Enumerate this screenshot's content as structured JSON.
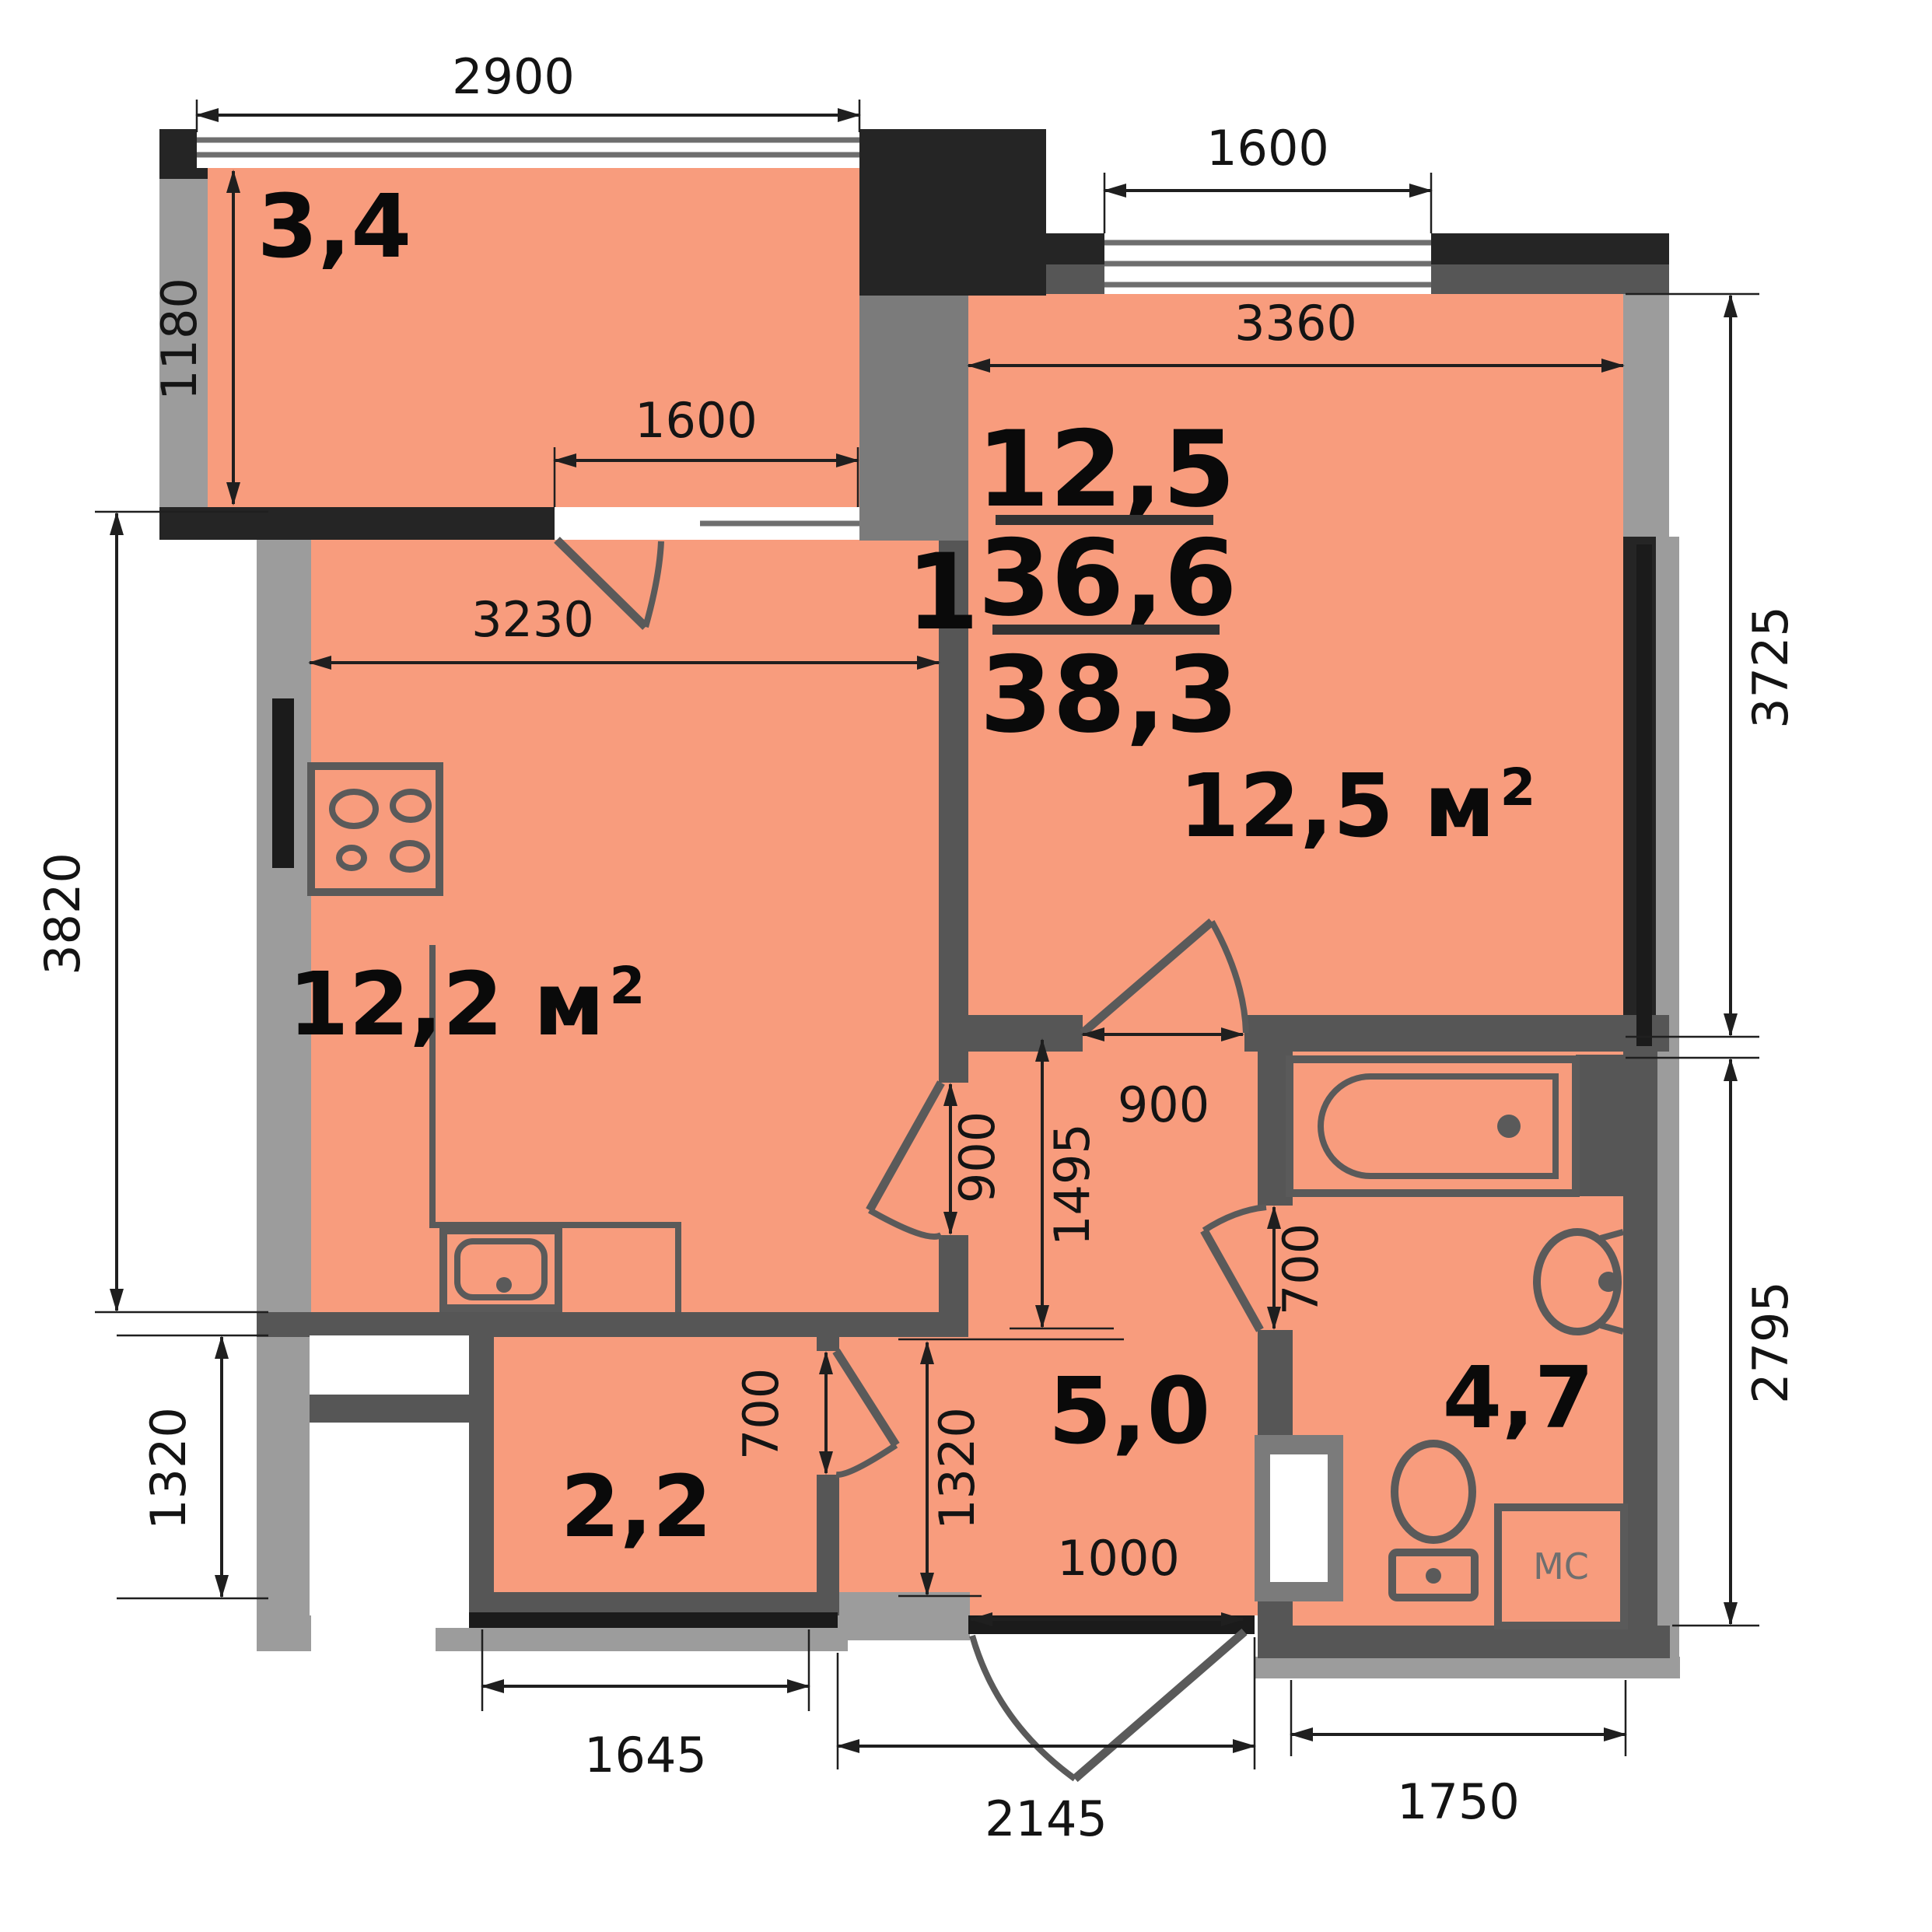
{
  "apartment_info": {
    "rooms_count": "1",
    "living_area": "12,5",
    "area": "36,6",
    "total_area": "38,3"
  },
  "room_labels": {
    "balcony": "3,4",
    "kitchen": "12,2 м",
    "kitchen_sup": "2",
    "living": "12,5 м",
    "living_sup": "2",
    "hall": "5,0",
    "closet": "2,2",
    "bathroom": "4,7",
    "washing_machine": "МС"
  },
  "dims": {
    "balcony_width": "2900",
    "balcony_depth": "1180",
    "balcony_door": "1600",
    "living_window": "1600",
    "living_width": "3360",
    "living_height": "3725",
    "kitchen_width": "3230",
    "kitchen_height": "3820",
    "left_lower": "1320",
    "kitchen_door": "900",
    "living_door": "900",
    "hall_length": "1495",
    "hall_lower": "1320",
    "bath_door": "700",
    "closet_door": "700",
    "closet_width": "1645",
    "entrance_door": "1000",
    "entrance_span": "2145",
    "bath_width": "1750",
    "bath_height": "2795"
  },
  "colors": {
    "floor": "#F89C7D",
    "wall": "#565656",
    "wall_dark": "#252525",
    "wall_black": "#1B1B1B",
    "band_light": "#9C9C9C",
    "band_mid": "#7B7B7B",
    "dim_line": "#1F1F1F"
  }
}
